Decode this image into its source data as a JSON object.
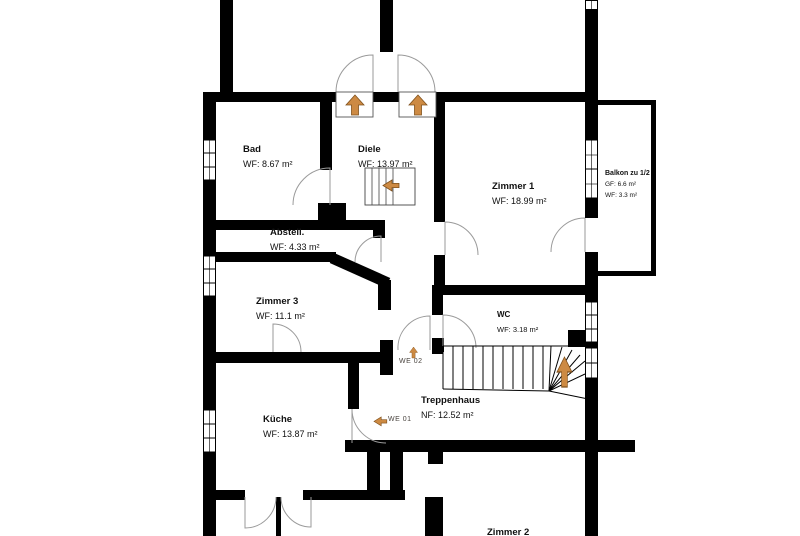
{
  "plan": {
    "title": "Obergeschoss Grundriss",
    "rooms": [
      {
        "id": "bad",
        "name": "Bad",
        "area": "WF: 8.67 m²"
      },
      {
        "id": "diele",
        "name": "Diele",
        "area": "WF: 13.97 m²"
      },
      {
        "id": "zimmer1",
        "name": "Zimmer 1",
        "area": "WF: 18.99 m²"
      },
      {
        "id": "balkon",
        "name": "Balkon zu 1/2",
        "area": "GF: 6.6 m²",
        "area2": "WF: 3.3 m²"
      },
      {
        "id": "abstell",
        "name": "Abstell.",
        "area": "WF: 4.33 m²"
      },
      {
        "id": "zimmer3",
        "name": "Zimmer 3",
        "area": "WF: 11.1 m²"
      },
      {
        "id": "wc",
        "name": "WC",
        "area": "WF: 3.18 m²"
      },
      {
        "id": "treppenhaus",
        "name": "Treppenhaus",
        "area": "NF: 12.52 m²"
      },
      {
        "id": "kueche",
        "name": "Küche",
        "area": "WF: 13.87 m²"
      },
      {
        "id": "zimmer2",
        "name": "Zimmer 2"
      }
    ],
    "markers": {
      "we01": "WE 01",
      "we02": "WE 02"
    },
    "colors": {
      "wall": "#000000",
      "arrow_fill": "#cd8a43",
      "arrow_outline": "#80511c",
      "door_arc": "#9a9a9a"
    }
  }
}
